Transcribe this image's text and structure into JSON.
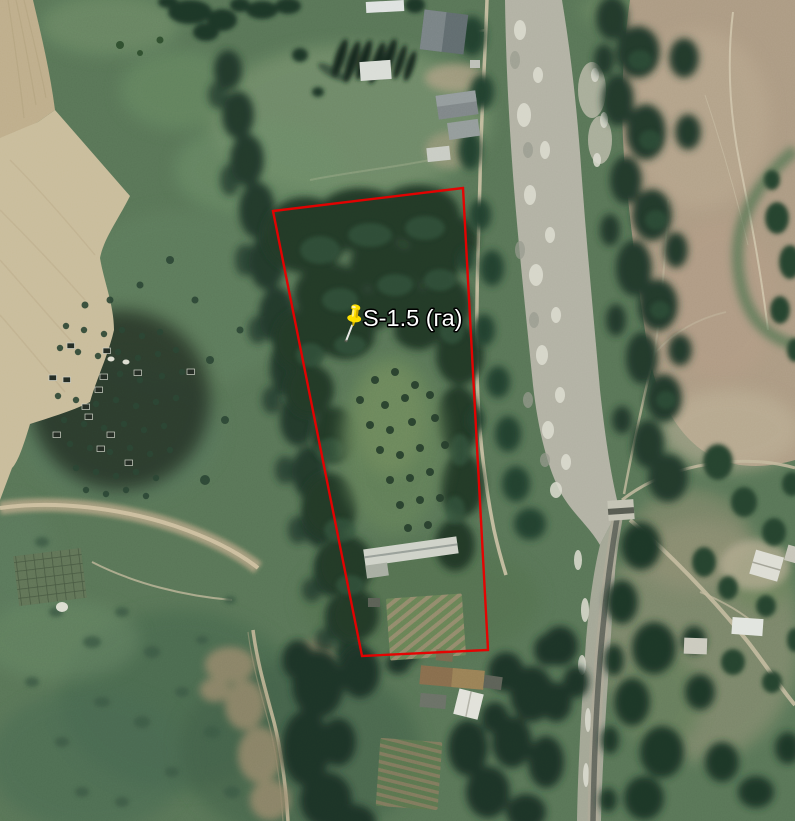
{
  "map": {
    "placemark": {
      "label": "S-1.5 (га)",
      "transform": "translate(354,320)",
      "pin_color": "#ffdf00",
      "label_color": "#ffffff",
      "label_outline_color": "#000000"
    },
    "parcel": {
      "points": "273,211 463,188 488,650 362,656",
      "outline_color": "#e80000"
    }
  }
}
